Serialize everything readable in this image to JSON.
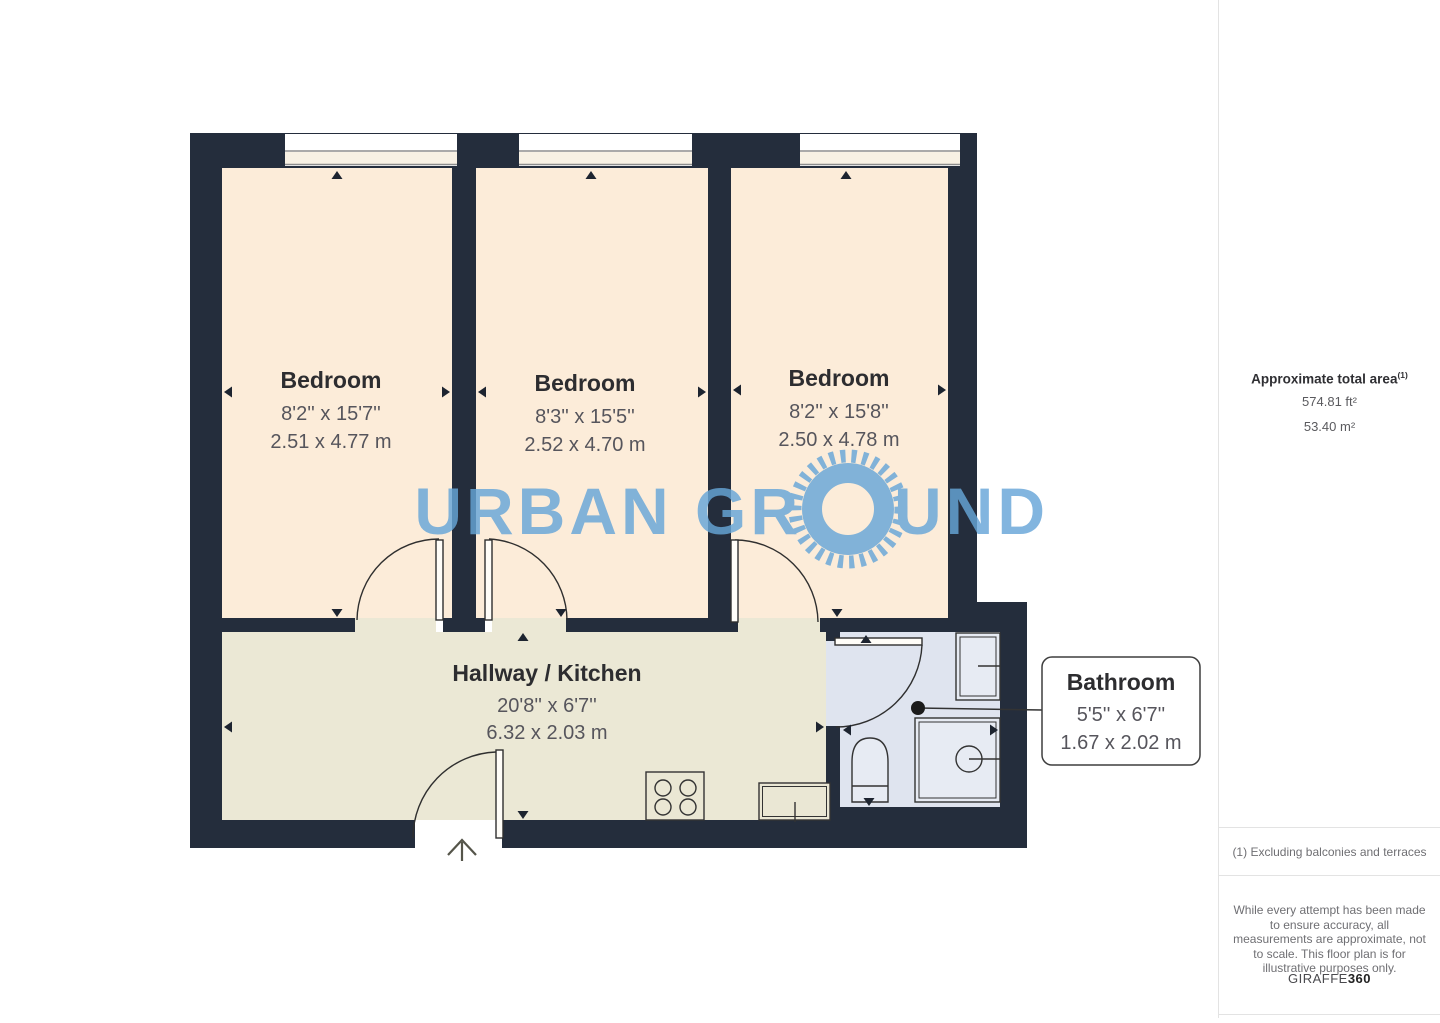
{
  "watermark": {
    "text_left": "URBAN GR",
    "text_right": "UND"
  },
  "rooms": {
    "bedroom1": {
      "name": "Bedroom",
      "imperial": "8'2'' x 15'7''",
      "metric": "2.51 x 4.77 m"
    },
    "bedroom2": {
      "name": "Bedroom",
      "imperial": "8'3'' x 15'5''",
      "metric": "2.52 x 4.70 m"
    },
    "bedroom3": {
      "name": "Bedroom",
      "imperial": "8'2'' x 15'8''",
      "metric": "2.50 x 4.78 m"
    },
    "hallway_kitchen": {
      "name": "Hallway / Kitchen",
      "imperial": "20'8'' x 6'7''",
      "metric": "6.32 x 2.03 m"
    },
    "bathroom": {
      "name": "Bathroom",
      "imperial": "5'5'' x 6'7''",
      "metric": "1.67 x 2.02 m"
    }
  },
  "sidebar": {
    "area_title": "Approximate total area",
    "area_ref": "(1)",
    "area_imperial": "574.81 ft²",
    "area_metric": "53.40 m²",
    "footnote": "(1) Excluding balconies and terraces",
    "disclaimer": "While every attempt has been made to ensure accuracy, all measurements are approximate, not to scale. This floor plan is for illustrative purposes only.",
    "brand_name": "GIRAFFE",
    "brand_suffix": "360"
  },
  "colors": {
    "wall": "#242d3c",
    "bedroom_floor": "#fcecd9",
    "hallway_floor": "#ebe8d5",
    "bathroom_floor": "#dfe4ef",
    "window_line": "#8d8d8d",
    "watermark_blue": "#67a6d8"
  }
}
